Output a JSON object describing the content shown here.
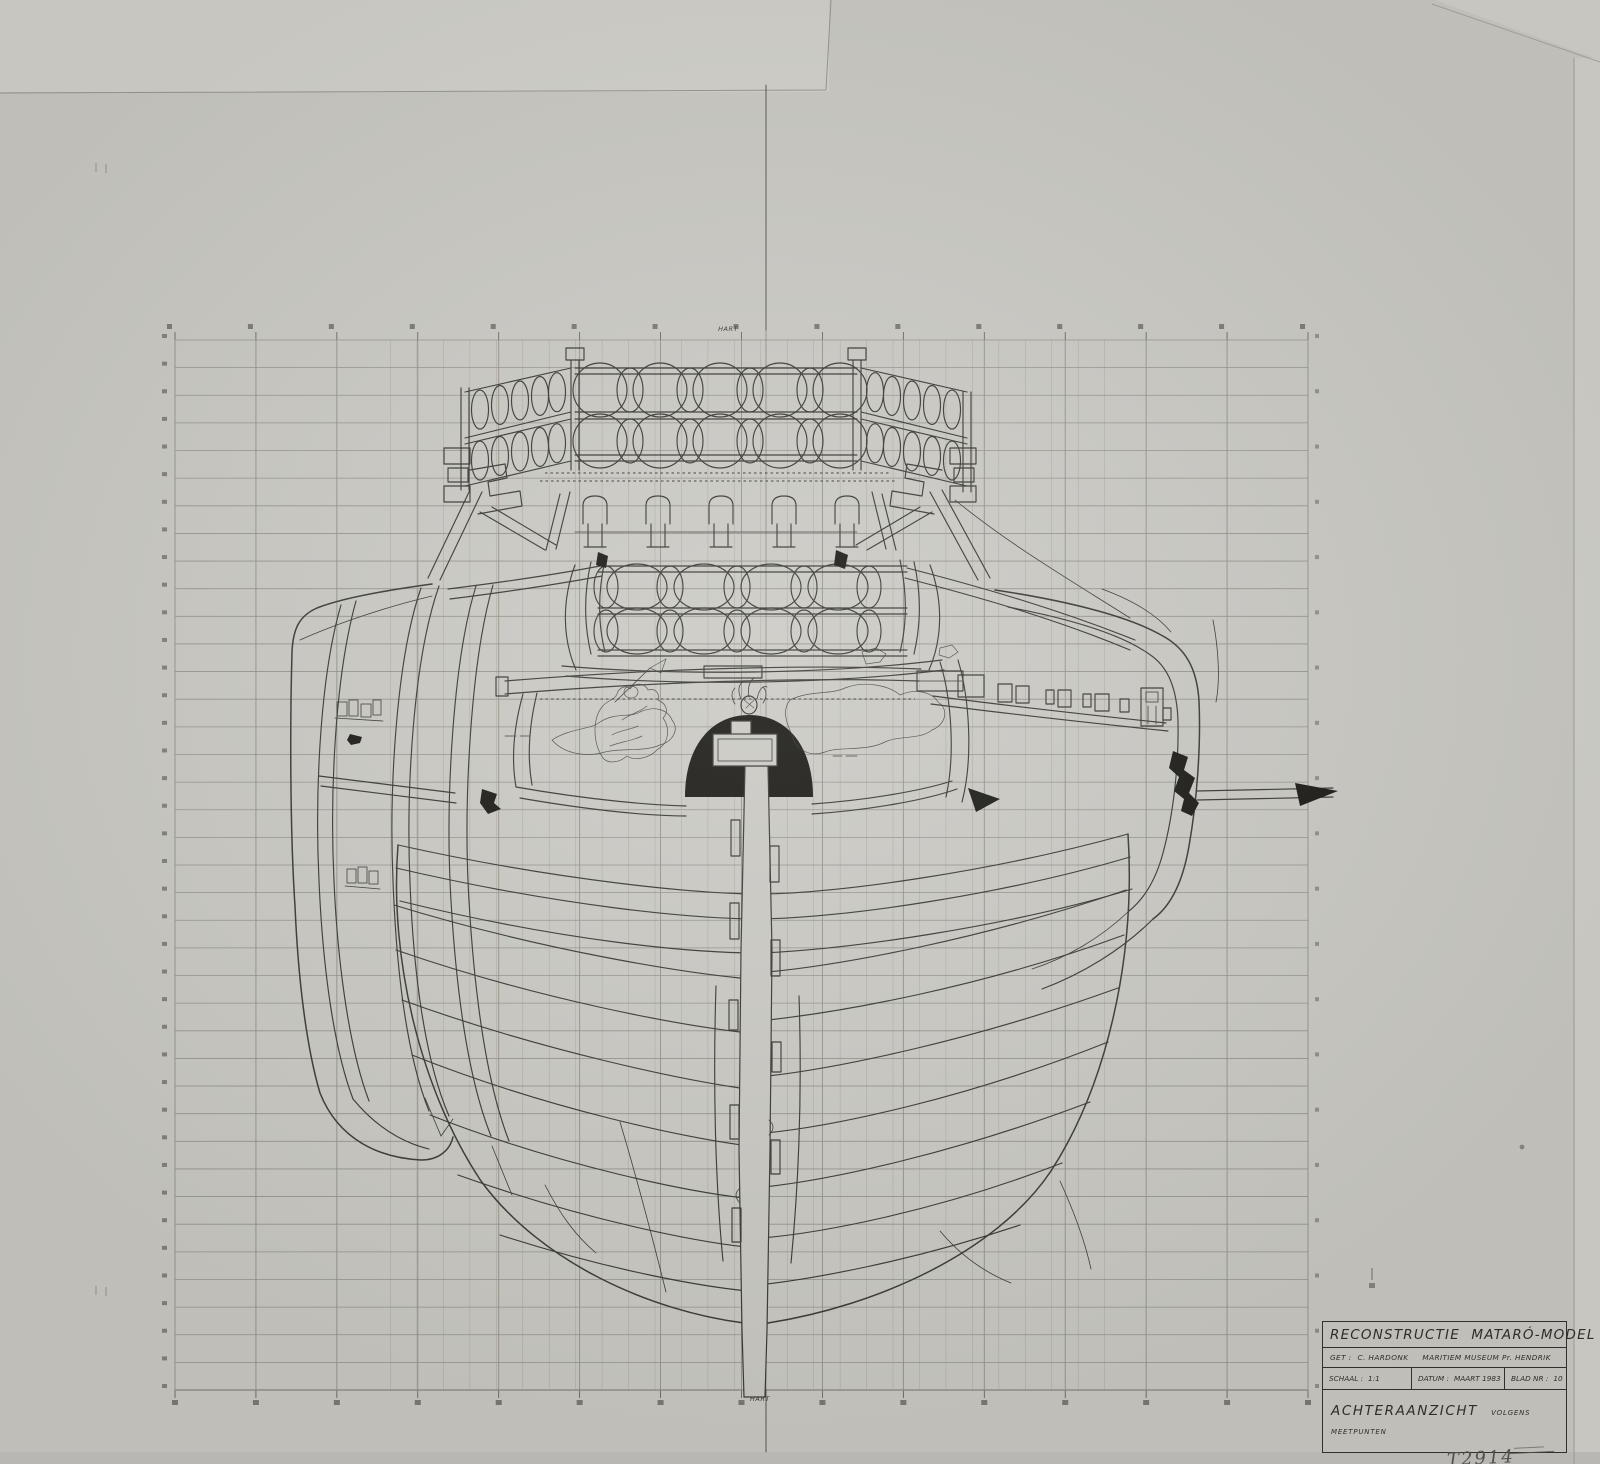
{
  "colors": {
    "paper": "#cbcac5",
    "paper_light": "#d3d2cd",
    "backing": "#c3c2be",
    "ink": "#3a3a36",
    "black": "#1c1b18",
    "grid_fine": "#ada99d",
    "grid_major": "#94918a",
    "tick": "#5a5952"
  },
  "labels": {
    "centerline_top": "HART",
    "centerline_bottom": "HART"
  },
  "title_block": {
    "title": "RECONSTRUCTIE MATARÓ-MODEL",
    "drawn_by_label": "GET :",
    "drawn_by": "C. HARDONK",
    "institution": "MARITIEM MUSEUM Pr. HENDRIK",
    "scale_label": "SCHAAL :",
    "scale": "1:1",
    "date_label": "DATUM :",
    "date": "MAART 1983",
    "sheet_label": "BLAD NR :",
    "sheet_number": "10",
    "view_title": "ACHTERAANZICHT",
    "view_qualifier": "VOLGENS MEETPUNTEN"
  },
  "annotations": {
    "inventory_note": "T2914"
  }
}
